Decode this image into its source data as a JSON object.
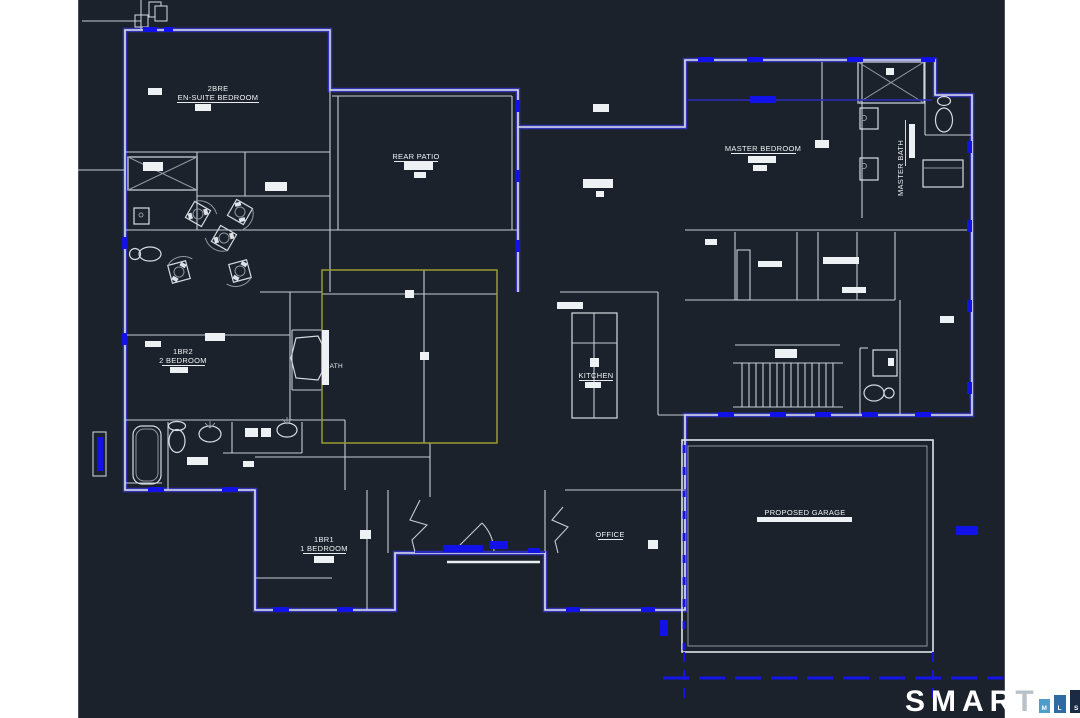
{
  "page": {
    "background": "#ffffff"
  },
  "canvas": {
    "background": "#1b222b",
    "left_px": 78,
    "width_px": 927
  },
  "colors": {
    "wall_primary": "#dfe3e9",
    "wall_secondary": "#8f97a1",
    "exterior_accent": "#3535bd",
    "highlight_blue": "#1212e8",
    "selection_yellow": "#9b9b2f",
    "label_text": "#f0f2f5"
  },
  "rooms": {
    "ensuite": {
      "line1": "2BRE",
      "line2": "EN-SUITE BEDROOM"
    },
    "rear_patio": {
      "label": "REAR PATIO"
    },
    "master_bedroom": {
      "label": "MASTER BEDROOM"
    },
    "master_bath": {
      "label": "MASTER BATH"
    },
    "bedroom2": {
      "line1": "1BR2",
      "line2": "2 BEDROOM"
    },
    "bath": {
      "label": "BATH"
    },
    "kitchen": {
      "label": "KITCHEN"
    },
    "bedroom1": {
      "line1": "1BR1",
      "line2": "1 BEDROOM"
    },
    "office": {
      "label": "OFFICE"
    },
    "garage": {
      "label": "PROPOSED GARAGE"
    }
  },
  "branding": {
    "wordmark_main": "SMAR",
    "wordmark_t": "T",
    "mls_squares": [
      {
        "letter": "M",
        "color": "#4f9dca"
      },
      {
        "letter": "L",
        "color": "#2e6ba3"
      },
      {
        "letter": "S",
        "color": "#1b2b44"
      }
    ]
  }
}
